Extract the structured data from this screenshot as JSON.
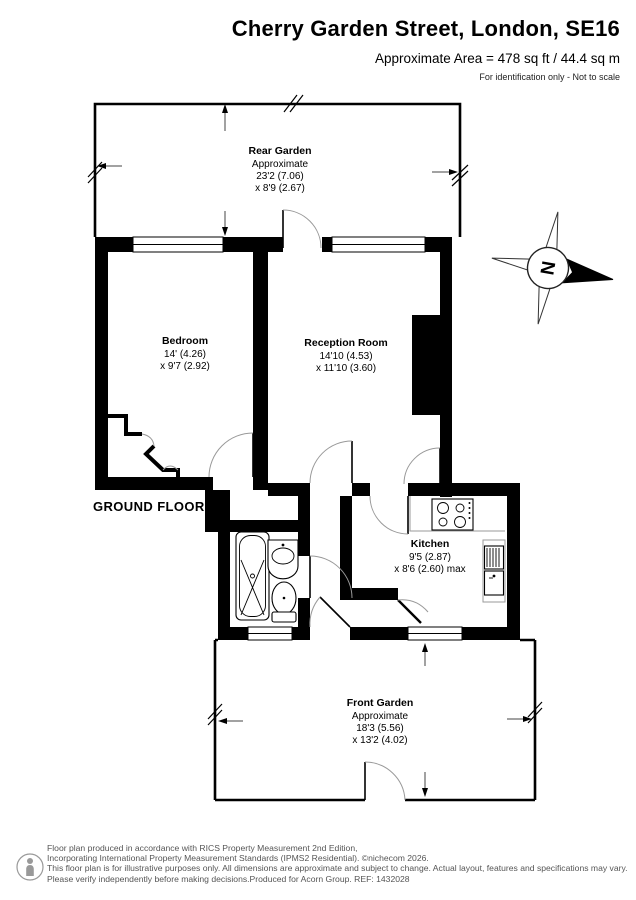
{
  "header": {
    "title": "Cherry Garden Street, London, SE16",
    "area_line": "Approximate Area = 478 sq ft / 44.4 sq m",
    "disclaimer": "For identification only - Not to scale"
  },
  "floor_label": "GROUND FLOOR",
  "compass": {
    "north_label": "N"
  },
  "rooms": {
    "rear_garden": {
      "name": "Rear Garden",
      "line1": "Approximate",
      "line2": "23'2 (7.06)",
      "line3": "x 8'9 (2.67)"
    },
    "bedroom": {
      "name": "Bedroom",
      "line1": "14' (4.26)",
      "line2": "x 9'7 (2.92)"
    },
    "reception": {
      "name": "Reception Room",
      "line1": "14'10 (4.53)",
      "line2": "x 11'10 (3.60)"
    },
    "kitchen": {
      "name": "Kitchen",
      "line1": "9'5 (2.87)",
      "line2": "x 8'6 (2.60) max"
    },
    "front_garden": {
      "name": "Front Garden",
      "line1": "Approximate",
      "line2": "18'3 (5.56)",
      "line3": "x 13'2 (4.02)"
    }
  },
  "footer": {
    "line1": "Floor plan produced in accordance with RICS Property Measurement 2nd Edition,",
    "line2": "Incorporating International Property Measurement Standards (IPMS2 Residential).  ©nichecom 2026.",
    "line3": "This floor plan is for illustrative purposes only. All dimensions are approximate and subject to change. Actual layout, features and specifications may vary.",
    "line4": "Please verify independently before making decisions.Produced for Acorn Group.   REF:  1432028"
  },
  "colors": {
    "wall": "#000000",
    "background": "#ffffff",
    "door_arc": "#999999",
    "footer_text": "#555555"
  }
}
